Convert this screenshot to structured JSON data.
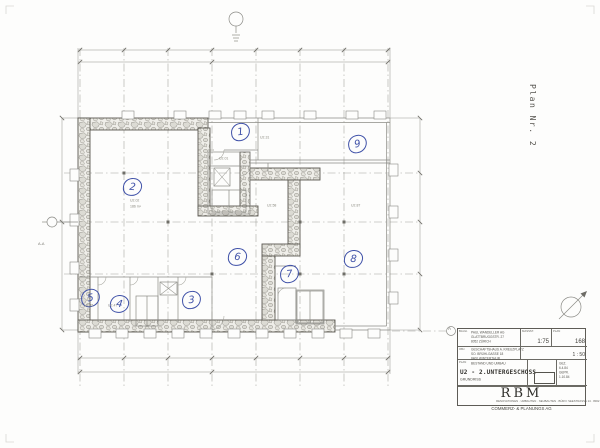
{
  "page": {
    "plan_label": "Plan Nr. 2"
  },
  "markers": {
    "section_label": "A-A",
    "grid_bubble": "A"
  },
  "annotations": {
    "ink_color": "#3f51a8",
    "numbers": [
      {
        "n": "1",
        "x": 239,
        "y": 131,
        "rot": -8
      },
      {
        "n": "2",
        "x": 131,
        "y": 186,
        "rot": 5
      },
      {
        "n": "3",
        "x": 190,
        "y": 299,
        "rot": -5
      },
      {
        "n": "4",
        "x": 118,
        "y": 303,
        "rot": 8
      },
      {
        "n": "5",
        "x": 89,
        "y": 297,
        "rot": -10
      },
      {
        "n": "6",
        "x": 236,
        "y": 256,
        "rot": 6
      },
      {
        "n": "7",
        "x": 288,
        "y": 273,
        "rot": -6
      },
      {
        "n": "8",
        "x": 352,
        "y": 258,
        "rot": 4
      },
      {
        "n": "9",
        "x": 356,
        "y": 143,
        "rot": -12
      }
    ]
  },
  "room_labels": [
    {
      "text": "U2.02",
      "x": 130,
      "y": 199
    },
    {
      "text": "186 m²",
      "x": 130,
      "y": 205
    },
    {
      "text": "U2.01",
      "x": 219,
      "y": 157
    },
    {
      "text": "U2.31",
      "x": 260,
      "y": 136
    },
    {
      "text": "U2.58",
      "x": 267,
      "y": 204
    },
    {
      "text": "U2.87",
      "x": 351,
      "y": 204
    },
    {
      "text": "U2.47",
      "x": 108,
      "y": 304
    },
    {
      "text": "U2.45",
      "x": 84,
      "y": 304
    }
  ],
  "title_block": {
    "client": {
      "label": "BAUH.",
      "lines": [
        "PAUL WANDELLER AG",
        "GLATTBRUGGSTR. 27",
        "8052 ZÜRICH"
      ]
    },
    "project": {
      "label": "OBJ.",
      "lines": [
        "GESCHÄFTSHAUS A. KREUZPLATZ",
        "SO. BRÜHLGASSE 18",
        "8400 WINTERTHUR"
      ]
    },
    "scale_box": {
      "label": "MASSST.",
      "value": "1:75"
    },
    "format_box": {
      "label": "PLAN",
      "value": "168"
    },
    "scale2": "1 : 50",
    "drawing": {
      "label": "PLAN",
      "line1": "BESTAND UND UMBAU",
      "title": "U2 - 2.UNTERGESCHOSS",
      "subtitle": "GRUNDRISS"
    },
    "revision_lines": [
      "GEZ.",
      "6.4.84",
      "GEPR.",
      "1.10.84"
    ],
    "firm": {
      "name": "RBM",
      "tagline": "RENOVATIONEN · UMBAUTEN · NEUBAUTEN · BÜRO: SEESTRASSE 14 · 8002 ZÜRICH · TELEFON 01 / 202 44 66",
      "subname": "COMMERZ- & PLANUNGS AG"
    }
  }
}
